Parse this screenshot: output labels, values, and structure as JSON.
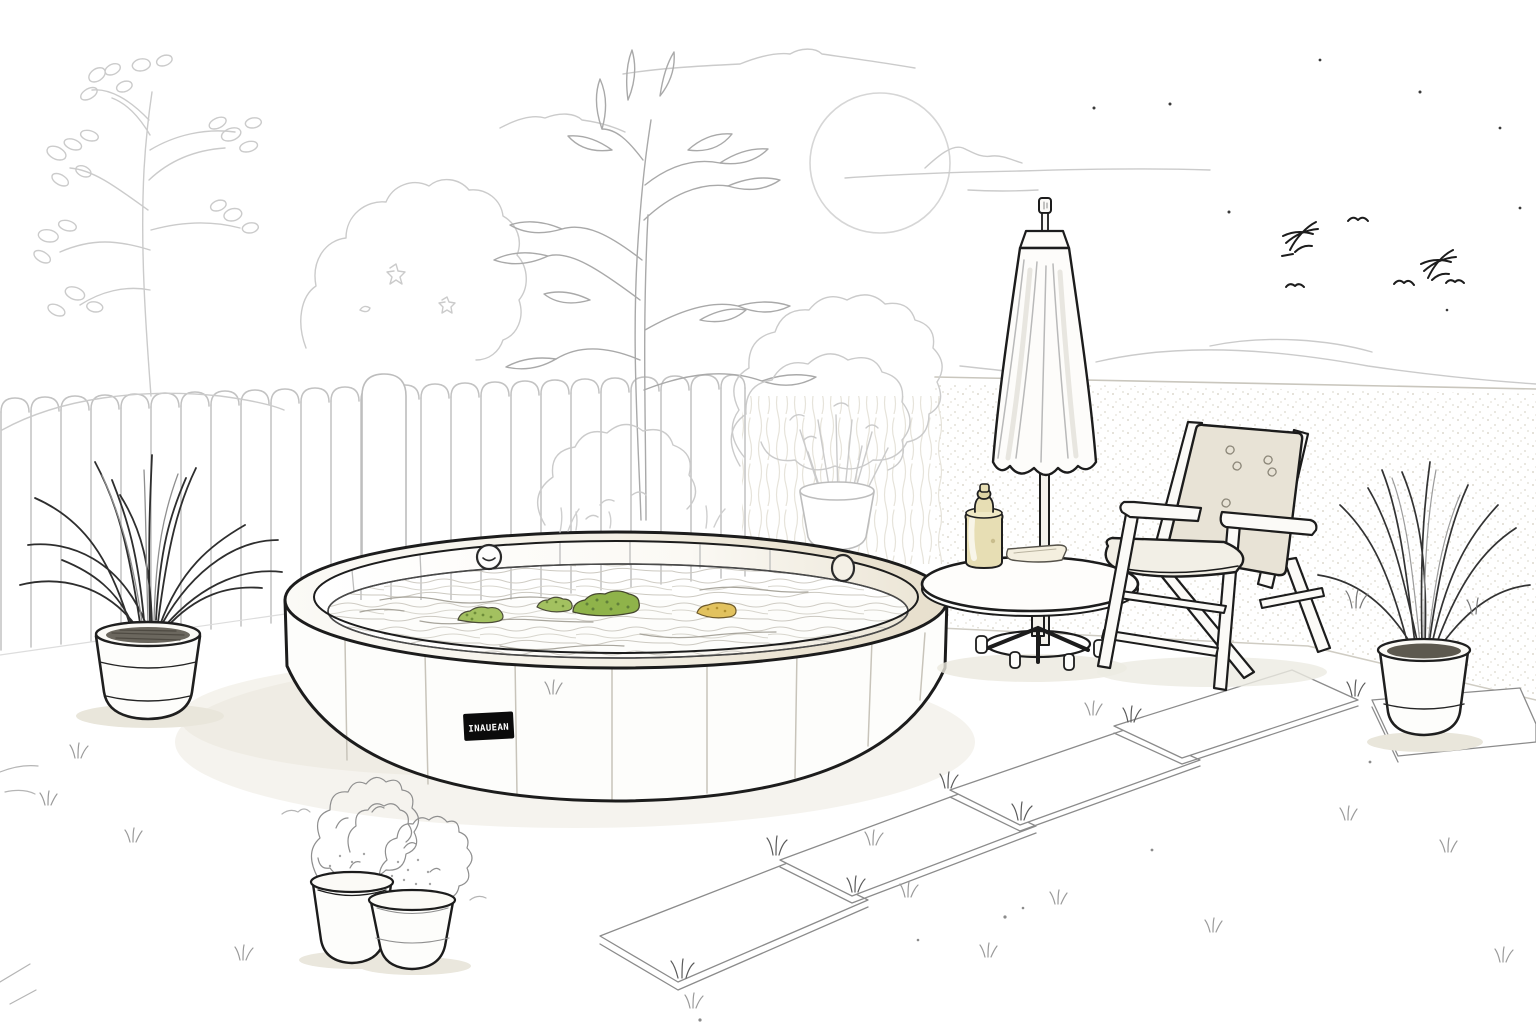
{
  "illustration": {
    "description": "Minimal black-and-white line drawing of a backyard: round above-ground pool with leaves floating on the water, closed patio umbrella through a round side table holding a bottle and folded towel, folding chair with beige cushion, picket fence with trees and bushes behind it, potted grass plants, two small flower pots, stepping-stone path, low garden wall, sun, clouds and birds.",
    "pool": {
      "brand_label": "INAUEAN",
      "floating_items": [
        {
          "name": "leaf-clump-small",
          "color": "#a3c160"
        },
        {
          "name": "leaf-clump-medium",
          "color": "#a3c160"
        },
        {
          "name": "leaf-clump-large",
          "color": "#8fb34a"
        },
        {
          "name": "yellow-float",
          "color": "#e2c25e"
        }
      ]
    },
    "colors": {
      "background": "#ffffff",
      "ink_dark": "#1c1c1c",
      "ink_light": "#cbcbcb",
      "rim_beige": "#e7dfcd",
      "cushion_beige": "#e8e3d6",
      "bottle_tan": "#e7deb4",
      "leaf_green": "#a3c160",
      "float_yellow": "#e2c25e",
      "soil_dark": "#6b675e",
      "shadow": "#ebe8de"
    },
    "objects": [
      "sun",
      "clouds",
      "stars",
      "birds",
      "picket-fence",
      "deciduous-tree",
      "round-bush",
      "tall-tree",
      "pedestal-potted-bush",
      "above-ground-pool",
      "pool-water",
      "floating-leaves",
      "pool-brand-label",
      "closed-umbrella",
      "side-table",
      "bottle",
      "folded-towel",
      "folding-chair",
      "left-potted-grass",
      "right-potted-grass",
      "flower-pots",
      "stepping-stones",
      "garden-wall",
      "grass-tufts"
    ]
  }
}
